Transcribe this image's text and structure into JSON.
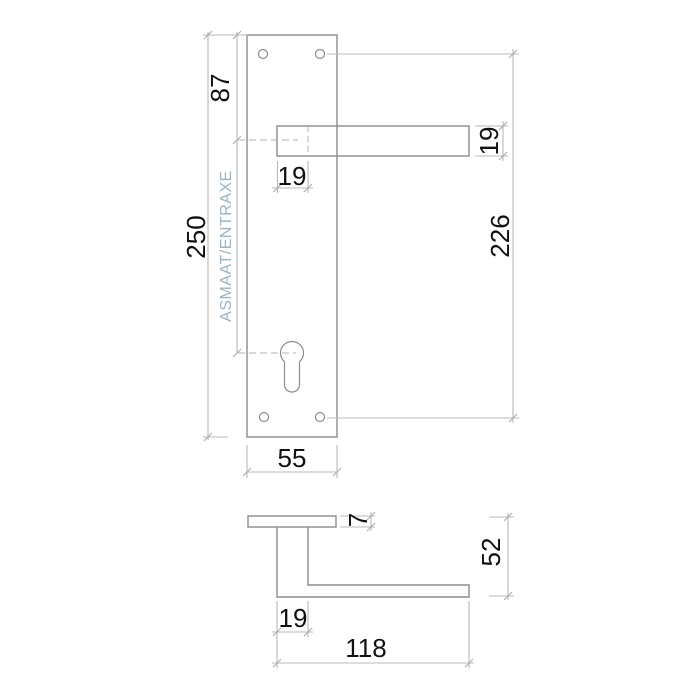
{
  "drawing": {
    "front_view": {
      "handle_center_from_top": "87",
      "plate_height": "250",
      "center_distance_label": "ASMAAT/ENTRAXE",
      "neck_width": "19",
      "lever_section_height": "19",
      "screw_hole_spacing": "226",
      "plate_width": "55"
    },
    "side_view": {
      "plate_thickness": "7",
      "handle_projection": "52",
      "neck_depth": "19",
      "lever_length": "118"
    },
    "colors": {
      "outline": "#8c8c8c",
      "dimension_lines": "#b8b8b8",
      "dimension_text": "#111111",
      "center_distance_label": "#9db3c2"
    }
  }
}
